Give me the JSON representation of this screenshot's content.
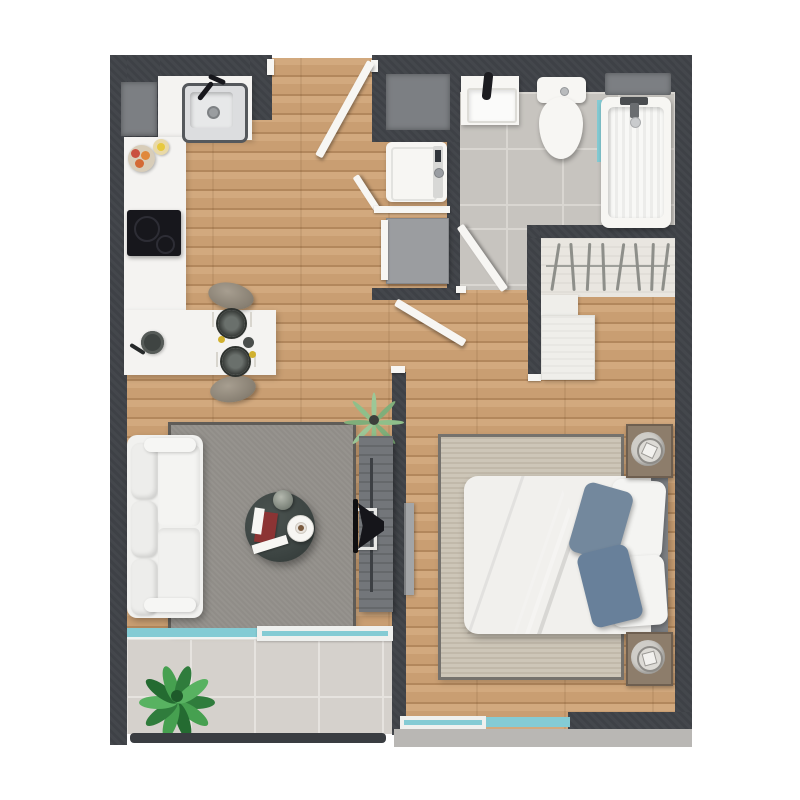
{
  "palette": {
    "bg": "#ffffff",
    "wall": "#3e4146",
    "niche": "#7c7f83",
    "wood": "#c99e72",
    "wood-light": "#d2a97e",
    "wood-dark": "#b2875c",
    "tile": "#c7c4bf",
    "tile-grout": "#d9d6d1",
    "balcony-tile": "#d5d1cc",
    "balcony-grout": "#e6e3df",
    "closet-floor": "#e9e6e0",
    "counter": "#f4f3f1",
    "white": "#f7f6f3",
    "steel": "#dcdddf",
    "black": "#17171c",
    "rug-gray": "#908d88",
    "rug-gray-border": "#5f5c58",
    "rug-beige": "#cdc6b8",
    "rug-beige-border": "#75726d",
    "sofa": "#f1f1ef",
    "marble": "#3d4543",
    "glass": "#84cbd4",
    "duvet": "#6e8296",
    "duvet-dark": "#60748a",
    "pillow-blue": "#73889d",
    "headboard": "#7c7f83",
    "console": "#73767a",
    "nightstand": "#8d7d6b",
    "appliance-gray": "#9b9da0",
    "plant-dark": "#2f7c3c",
    "plant-mid": "#46a050",
    "plant-deep": "#246b31",
    "plant-light": "#8fbf8a",
    "railing": "#3a3d41",
    "ledge": "#b9b7b4"
  },
  "plan": {
    "type": "apartment-floor-plan",
    "view": "top-down",
    "rooms": [
      {
        "name": "kitchen",
        "furniture": [
          "counter",
          "sink",
          "faucet",
          "induction-cooktop",
          "dining-island",
          "stool",
          "stool",
          "place-setting",
          "place-setting",
          "fruit-bowl",
          "pan"
        ]
      },
      {
        "name": "hallway",
        "furniture": [
          "entry-door",
          "washing-machine",
          "dryer",
          "laundry-door",
          "utility-niche"
        ]
      },
      {
        "name": "bathroom",
        "furniture": [
          "vanity-sink",
          "toilet",
          "bathtub",
          "tub-faucet",
          "glass-partition",
          "bathroom-door",
          "window"
        ]
      },
      {
        "name": "walk-in-closet",
        "furniture": [
          "hanging-rod",
          "hangers",
          "dresser"
        ]
      },
      {
        "name": "living-room",
        "furniture": [
          "sofa",
          "area-rug",
          "coffee-table",
          "vase",
          "magazines",
          "side-table",
          "coffee-cup",
          "tv-console",
          "tv",
          "potted-plant",
          "sliding-door",
          "balcony-glass-door"
        ]
      },
      {
        "name": "bedroom",
        "furniture": [
          "double-bed",
          "duvet",
          "pillow",
          "pillow",
          "pillow",
          "pillow",
          "headboard",
          "nightstand",
          "nightstand",
          "area-rug",
          "bedroom-door",
          "window"
        ]
      },
      {
        "name": "balcony",
        "furniture": [
          "floor-tiles",
          "plant",
          "railing"
        ]
      }
    ]
  }
}
